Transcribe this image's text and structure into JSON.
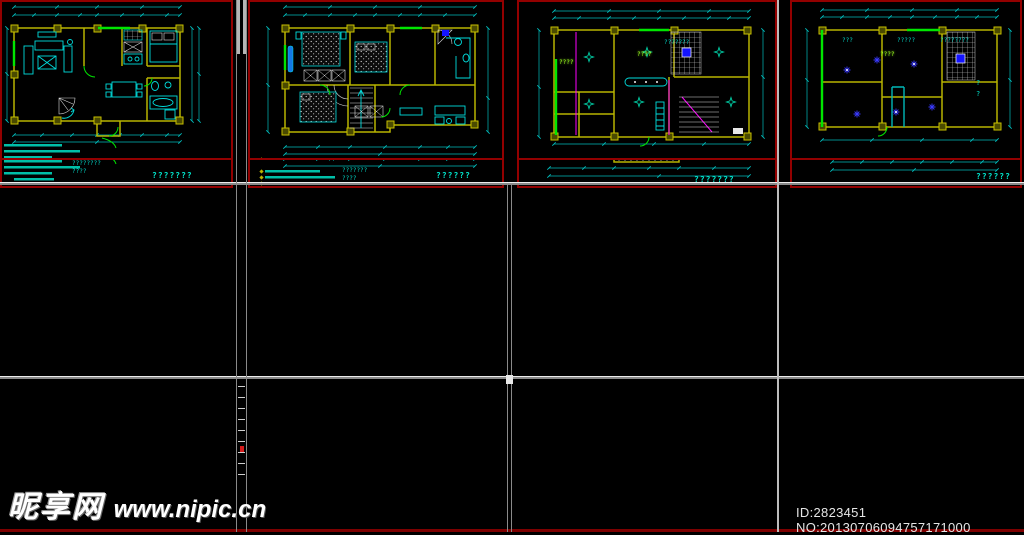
{
  "watermark": {
    "site_name": "昵享网",
    "site_url": "www.nipic.cn"
  },
  "footer_id": "ID:2823451 NO:20130706094757171000",
  "colors": {
    "wall_yellow": "#b8b400",
    "accent_green": "#00e600",
    "cyan": "#00dcdc",
    "dim_cyan": "#00bdbd",
    "wire_red": "#ff2020",
    "magenta": "#ff00ff",
    "legend_blue": "#1414ff",
    "panel_border_red": "#930000",
    "divider_gray": "#8a8a8a",
    "label_teal": "#00a070"
  },
  "panels": {
    "p1": {
      "title_label": "???????",
      "top_label": "????????"
    },
    "p2": {
      "title_label": "???????",
      "top_labels": [
        "?????",
        "????????"
      ],
      "qmark": "?\n?"
    },
    "p3": {
      "title_label": "?????",
      "qmark": "?\n?"
    },
    "p4": {
      "title_label": "?????"
    },
    "p5": {
      "title_label": "???????",
      "top_label": "??????",
      "notes": "????????\n????"
    },
    "p6": {
      "title_label": "??????",
      "note_mark": "??",
      "notes": "???????\n????",
      "qmark": "?\n?"
    },
    "p7": {
      "title_label": "???????",
      "top_labels": [
        "??????",
        "?????"
      ]
    },
    "p8": {
      "title_label": "??????",
      "top_labels": [
        "???????",
        "?????",
        "????????"
      ],
      "side_label": "???????"
    },
    "p11": {
      "top_label": "???????",
      "marks": [
        "????",
        "????"
      ]
    },
    "p12": {
      "top_labels": [
        "???",
        "?????",
        "????????"
      ],
      "qmark": "?\n?",
      "marks": [
        "????"
      ]
    }
  }
}
